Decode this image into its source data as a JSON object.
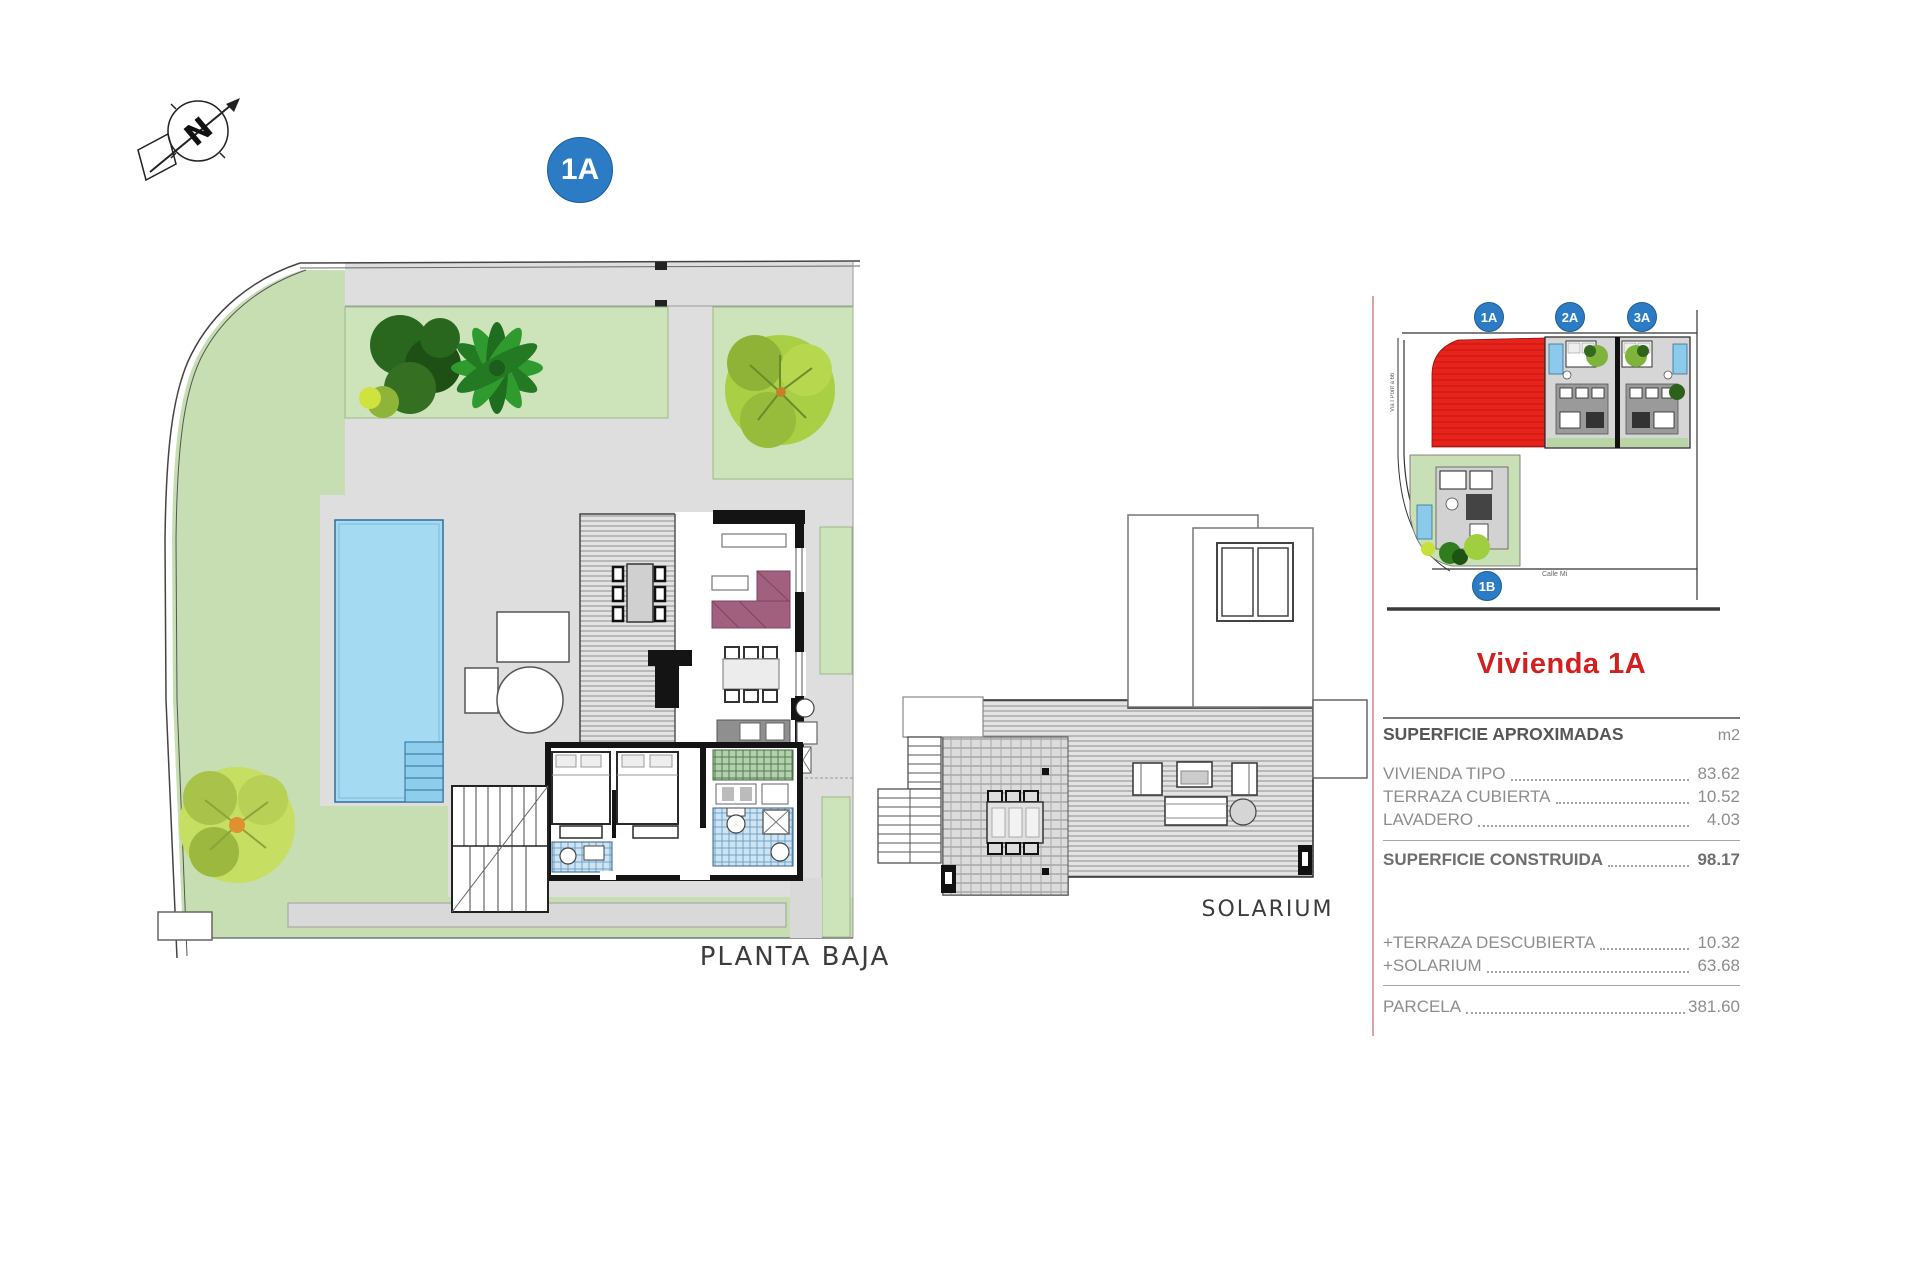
{
  "compass": {
    "letter": "N"
  },
  "badge_main": {
    "label": "1A"
  },
  "plans": {
    "ground_floor_label": "PLANTA BAJA",
    "solarium_label": "SOLARIUM"
  },
  "minimap": {
    "badges": [
      {
        "label": "1A"
      },
      {
        "label": "2A"
      },
      {
        "label": "3A"
      },
      {
        "label": "1B"
      }
    ],
    "street_label_bottom": "Calle Mi",
    "street_label_left": "Via I Pont a 66",
    "highlight_color": "#e7231c"
  },
  "panel": {
    "title": "Vivienda 1A",
    "table_header": {
      "label": "SUPERFICIE APROXIMADAS",
      "unit": "m2"
    },
    "rows": [
      {
        "label": "VIVIENDA TIPO",
        "value": "83.62"
      },
      {
        "label": "TERRAZA CUBIERTA",
        "value": "10.52"
      },
      {
        "label": "LAVADERO",
        "value": "4.03"
      },
      {
        "label": "SUPERFICIE CONSTRUIDA",
        "value": "98.17"
      },
      {
        "label": "+TERRAZA DESCUBIERTA",
        "value": "10.32"
      },
      {
        "label": "+SOLARIUM",
        "value": "63.68"
      },
      {
        "label": "PARCELA",
        "value": "381.60"
      }
    ],
    "colors": {
      "accent_red": "#d21f1f",
      "badge_blue": "#2b7cc4",
      "text_gray": "#8d8d8d"
    }
  }
}
